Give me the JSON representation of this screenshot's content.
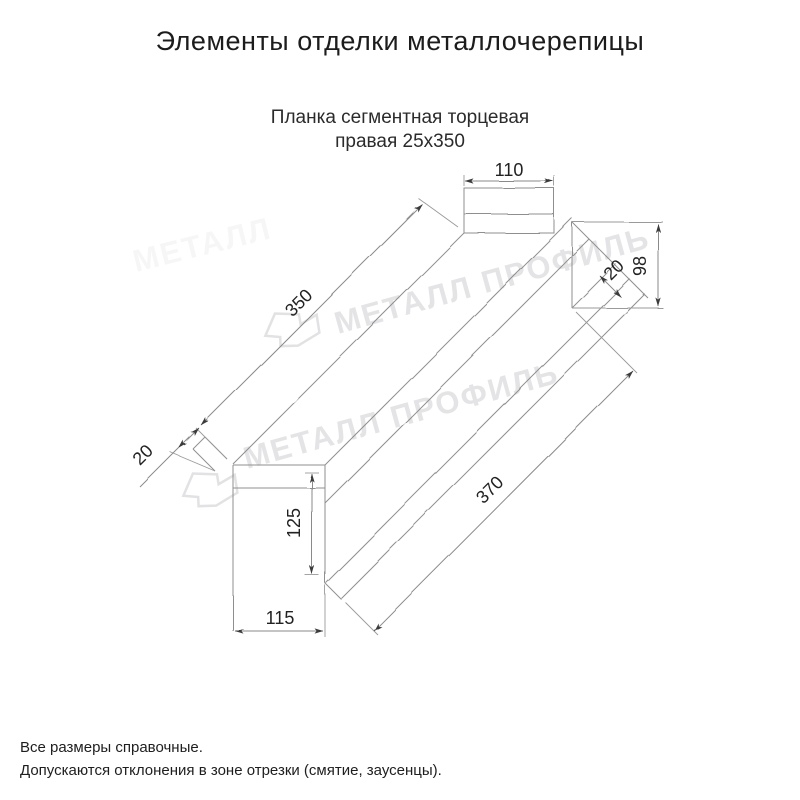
{
  "header": {
    "title": "Элементы отделки металлочерепицы"
  },
  "product": {
    "subtitle_line1": "Планка сегментная торцевая",
    "subtitle_line2": "правая 25х350"
  },
  "drawing": {
    "dimensions": {
      "top_flange_width": "110",
      "upper_face_length": "350",
      "left_end_hem": "20",
      "right_end_height": "98",
      "right_end_hem": "20",
      "base_height": "125",
      "base_width": "115",
      "lower_face_length": "370"
    }
  },
  "watermark": {
    "text": "МЕТАЛЛ ПРОФИЛЬ",
    "text_faint": "МЕТАЛЛ",
    "color": "#e4e4e6",
    "logo_color": "#e2e2e4"
  },
  "footer": {
    "line1": "Все размеры справочные.",
    "line2": "Допускаются отклонения в зоне отрезки (смятие, заусенцы)."
  }
}
